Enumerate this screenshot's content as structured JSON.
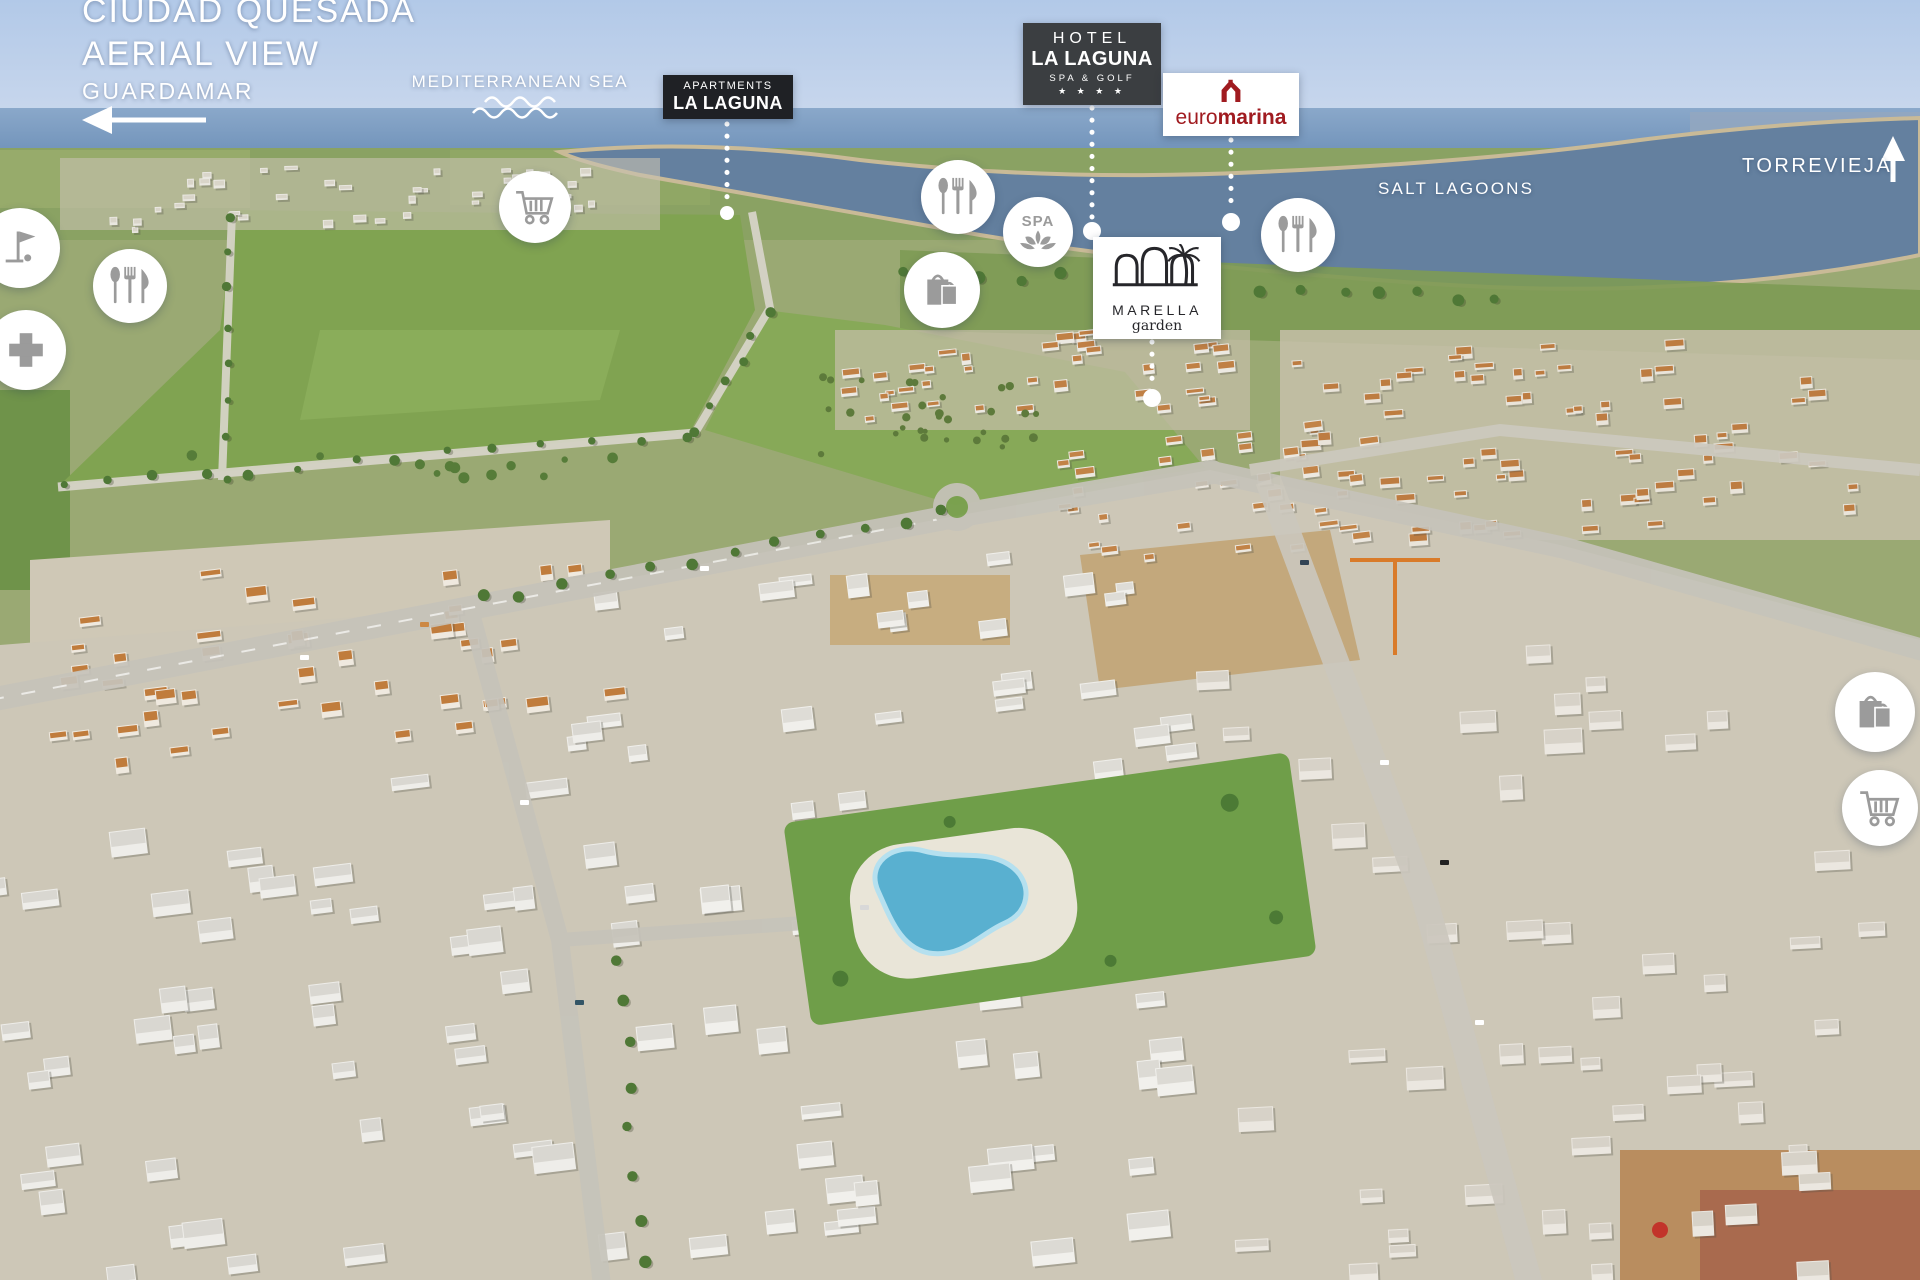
{
  "header": {
    "title_line1": "CIUDAD QUESADA",
    "title_line2": "AERIAL VIEW"
  },
  "direction_markers": {
    "guardamar": {
      "label": "GUARDAMAR",
      "arrow": "left"
    },
    "torrevieja": {
      "label": "TORREVIEJA",
      "arrow": "up"
    }
  },
  "sea_labels": {
    "mediterranean_sea": "MEDITERRANEAN SEA",
    "salt_lagoons": "SALT LAGOONS"
  },
  "badges": {
    "apartments_la_laguna": {
      "line1": "APARTMENTS",
      "line2": "LA LAGUNA"
    },
    "hotel_la_laguna": {
      "line1": "HOTEL",
      "line2": "LA LAGUNA",
      "line3": "SPA & GOLF",
      "stars": "★ ★ ★ ★"
    },
    "euromarina": {
      "part1": "euro",
      "part2": "marina"
    },
    "marella_garden": {
      "name": "MARELLA",
      "sub": "garden"
    }
  },
  "icons": {
    "spa_text": "SPA",
    "legend": {
      "restaurant-icon": "spoon-fork-knife cutlery",
      "shopping-cart-icon": "supermarket trolley",
      "shopping-bags-icon": "two shopping bags",
      "medical-cross-icon": "medical cross",
      "golf-icon": "golf flag with ball",
      "spa-icon": "lotus flower with SPA text",
      "arrow-left-icon": "direction arrow to Guardamar",
      "arrow-up-icon": "direction arrow to Torrevieja",
      "sea-waves-icon": "wavy sea lines"
    }
  },
  "colors": {
    "text_white": "#ffffff",
    "badge_dark": "#1f2125",
    "hotel_badge_gray": "#3b3e41",
    "euromarina_red": "#a01b20",
    "marella_ink": "#26262a",
    "icon_gray": "#9b9b9b",
    "pool_blue": "#59b0d0",
    "lawn_green": "#6f9e49"
  }
}
